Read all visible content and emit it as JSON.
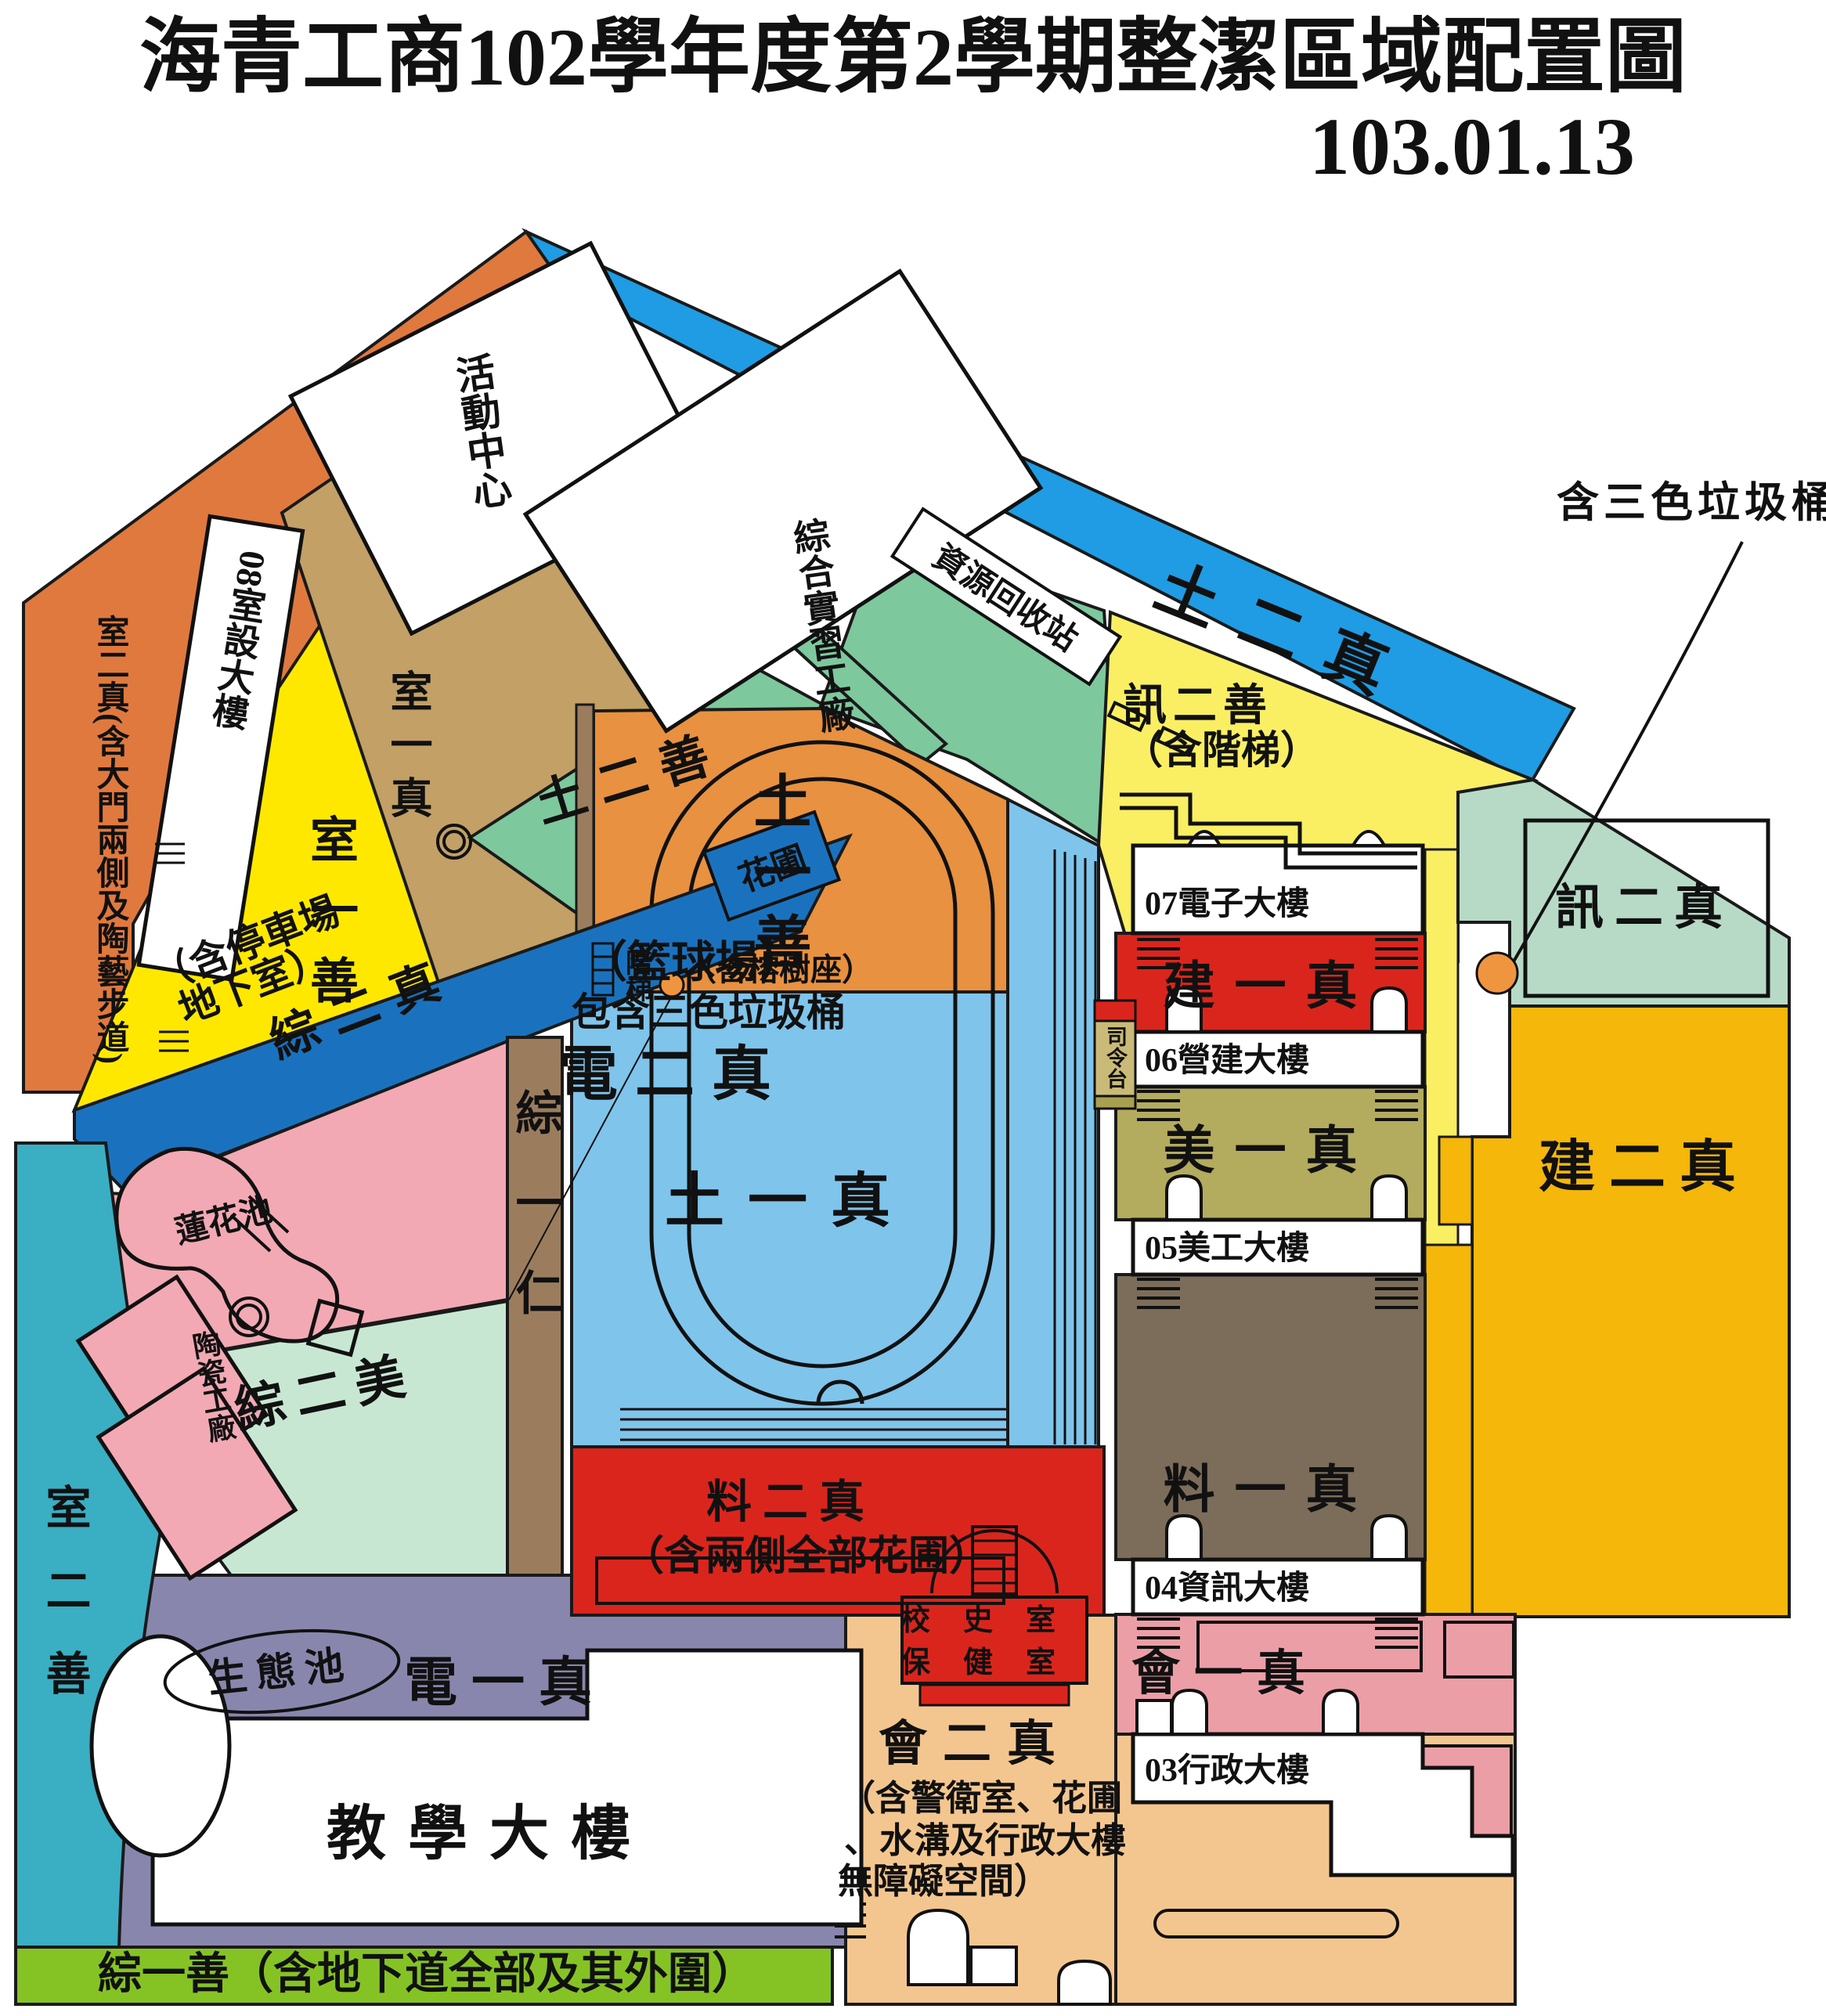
{
  "title": {
    "main": "海青工商102學年度第2學期整潔區域配置圖",
    "date": "103.01.13"
  },
  "colors": {
    "orange_band": "#E0793E",
    "blue_band": "#1F9CE4",
    "deep_blue": "#1A72BE",
    "yellow": "#FFE800",
    "pale_yellow": "#FAEF63",
    "tan": "#C2A066",
    "green_mid": "#7EC89D",
    "green_pale": "#C8E7D2",
    "green_info": "#B7DAC6",
    "pink": "#F2A9B4",
    "pink_band": "#EC9EA6",
    "brown_strip": "#9B7D5E",
    "brown_band": "#7C6D5A",
    "track_orange": "#E89140",
    "track_blue": "#7FC4EB",
    "red": "#DA251D",
    "olive": "#B3AB5E",
    "gold": "#F4B70A",
    "purple": "#8986AE",
    "teal": "#3AAEC3",
    "green_strip": "#85C325",
    "tan_light": "#F4C68F",
    "stage_tan": "#C9BA77",
    "dot_orange": "#F0953F",
    "white": "#FFFFFF"
  },
  "regions": {
    "outer_left_band": "室二真(含大門兩側及陶藝步道)",
    "outer_top_band": "土二真",
    "yellow_left": "室一善",
    "tan_area": "室一真",
    "green_diag": "土二善",
    "parking_band": "綜二真",
    "parking_note1": "（含停車場",
    "parking_note2": "地下室）",
    "flowerbed": "花圃",
    "court_note1": "（籃球場）",
    "court_note2": "包含三色垃圾桶",
    "court_name": "電二真",
    "lotus_pond": "蓮花池",
    "ceramics": "陶瓷工廠",
    "zong_yi_ren": "綜一仁",
    "zong_er_mei": "綜二美",
    "track_top1": "土一善",
    "track_top2": "（含榕樹座）",
    "track_bottom": "土一真",
    "stairs": "階梯",
    "xun_er_shan": "訊二善",
    "xun_er_shan_note": "（含階梯）",
    "jian_yi_zhen": "建一真",
    "mei_yi_zhen": "美一真",
    "liao_yi_zhen": "料一真",
    "hui_yi_zhen": "會一真",
    "xun_er_zhen": "訊二真",
    "jian_er_zhen": "建二真",
    "liao_er_zhen": "料二真",
    "liao_er_zhen_note": "（含兩側全部花圃）",
    "school_history": "校史室",
    "health_room": "保健室",
    "stage": "司令台",
    "dian_yi_zhen": "電一真",
    "eco_pond": "生態池",
    "teal_left": "室二善",
    "bottom_strip": "綜一善（含地下道全部及其外圍）",
    "hui_er_zhen": "會二真",
    "hui_er_note1": "（含警衛室、花圃",
    "hui_er_note2": "、水溝及行政大樓",
    "hui_er_note3": "無障礙空間）",
    "trash_note": "含三色垃圾桶",
    "recycle_station": "資源回收站"
  },
  "buildings": {
    "b08": "08室設大樓",
    "activity_center": "活動中心",
    "practice_factory": "綜合實習工廠",
    "b07": "07電子大樓",
    "b06": "06營建大樓",
    "b05": "05美工大樓",
    "b04": "04資訊大樓",
    "b03": "03行政大樓",
    "teaching": "教學大樓"
  }
}
